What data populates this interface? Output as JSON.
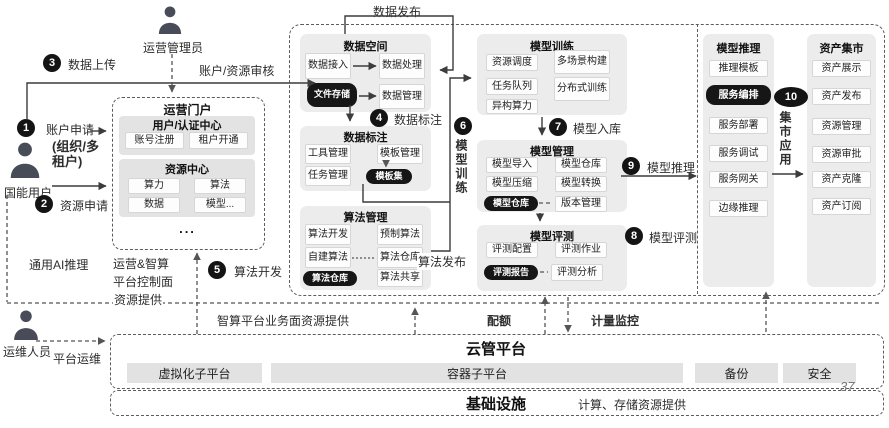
{
  "slide": {
    "page_number": "37"
  },
  "actors": {
    "admin": "运营管理员",
    "user": "国能用户",
    "ops": "运维人员"
  },
  "steps": [
    {
      "num": "1",
      "label": "账户申请"
    },
    {
      "num": "2",
      "label": "资源申请"
    },
    {
      "num": "3",
      "label": "数据上传"
    },
    {
      "num": "4",
      "label": "数据标注"
    },
    {
      "num": "5",
      "label": "算法开发"
    },
    {
      "num": "6",
      "label": "模型训练"
    },
    {
      "num": "7",
      "label": "模型入库"
    },
    {
      "num": "8",
      "label": "模型评测"
    },
    {
      "num": "9",
      "label": "模型推理"
    },
    {
      "num": "10",
      "label": "集市应用"
    }
  ],
  "step1_note_lines": [
    "(组织/多",
    "租户)"
  ],
  "flows": {
    "account_review": "账户/资源审核",
    "data_publish": "数据发布",
    "algo_publish": "算法发布",
    "general_ai_inference": "通用AI推理",
    "control_plane_lines": [
      "运营&智算",
      "平台控制面",
      "资源提供"
    ],
    "business_plane": "智算平台业务面资源提供",
    "quota": "配额",
    "metering": "计量监控",
    "platform_ops": "平台运维"
  },
  "portal": {
    "title": "运营门户",
    "auth_center": {
      "title": "用户/认证中心",
      "items": [
        "账号注册",
        "租户开通"
      ]
    },
    "resource_center": {
      "title": "资源中心",
      "items": [
        "算力",
        "算法",
        "数据",
        "模型..."
      ]
    },
    "more": "..."
  },
  "panels": {
    "data_space": {
      "title": "数据空间",
      "access": "数据接入",
      "process": "数据处理",
      "storage": "文件存储",
      "manage": "数据管理"
    },
    "data_label": {
      "title": "数据标注",
      "tool": "工具管理",
      "template": "模板管理",
      "task": "任务管理",
      "template_set": "模板集"
    },
    "algo": {
      "title": "算法管理",
      "dev": "算法开发",
      "prebuilt": "预制算法",
      "selfbuilt": "自建算法",
      "repo": "算法仓库",
      "share": "算法共享",
      "repo_dark": "算法仓库"
    },
    "train": {
      "title": "模型训练",
      "schedule": "资源调度",
      "multi_scene": "多场景构建",
      "queue": "任务队列",
      "distributed": "分布式训练",
      "hetero": "异构算力"
    },
    "model_mgmt": {
      "title": "模型管理",
      "import": "模型导入",
      "repo": "模型仓库",
      "compress": "模型压缩",
      "convert": "模型转换",
      "repo_dark": "模型仓库",
      "version": "版本管理"
    },
    "eval": {
      "title": "模型评测",
      "config": "评测配置",
      "job": "评测作业",
      "report": "评测报告",
      "analysis": "评测分析"
    },
    "infer": {
      "title": "模型推理",
      "template": "推理模板",
      "orchestration": "服务编排",
      "deploy": "服务部署",
      "debug": "服务调试",
      "gateway": "服务网关",
      "edge": "边缘推理"
    },
    "market": {
      "title": "资产集市",
      "items": [
        "资产展示",
        "资产发布",
        "资源管理",
        "资源审批",
        "资产克隆",
        "资产订阅"
      ]
    }
  },
  "bottom": {
    "cloud_title": "云管平台",
    "virtualization": "虚拟化子平台",
    "container": "容器子平台",
    "backup": "备份",
    "security": "安全",
    "infra_title": "基础设施",
    "infra_note": "计算、存储资源提供"
  }
}
